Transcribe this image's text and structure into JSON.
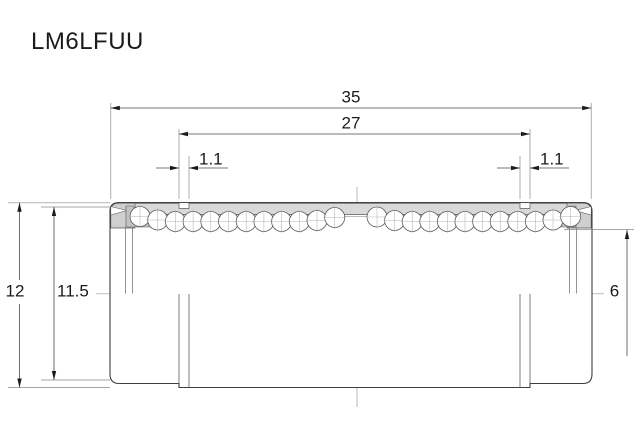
{
  "title": "LM6LFUU",
  "diagram": {
    "type": "engineering cross-section drawing of a linear ball bushing",
    "dim_overall_length": "35",
    "dim_groove_span": "27",
    "dim_groove_width_left": "1.1",
    "dim_groove_width_right": "1.1",
    "dim_outer_diameter": "12",
    "dim_groove_diameter": "11.5",
    "dim_bore_diameter": "6"
  },
  "colors": {
    "background": "#ffffff",
    "body_line": "#3f3f3f",
    "dim_line": "#4a4a4a",
    "extension_line": "#8a8a8a",
    "centerline": "#9a9a9a",
    "shell_fill": "#d9d9d9",
    "cap_fill": "#cfcfcf",
    "wedge_fill": "#c3c3c3",
    "text": "#1b1b1b"
  }
}
